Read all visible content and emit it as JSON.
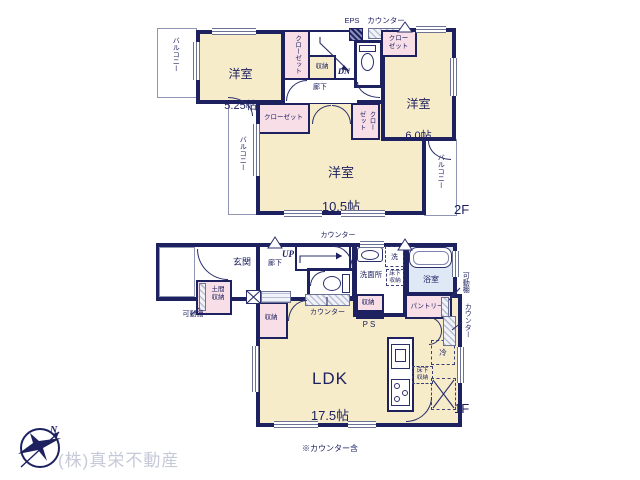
{
  "colors": {
    "wall_navy": "#1e2160",
    "room_cream": "#f7ecca",
    "closet_pink": "#f8dee6",
    "bath_blue": "#dfe9f5",
    "outline_gray": "#8f96b5",
    "logo_gray": "#c6c9d8"
  },
  "floor2": {
    "floor_label": "2F",
    "room525_name": "洋室",
    "room525_size": "5.25帖",
    "room60_name": "洋室",
    "room60_size": "6.0帖",
    "room105_name": "洋室",
    "room105_size": "10.5帖",
    "balcony_top": "バルコニー",
    "balcony_left": "バルコニー",
    "balcony_right": "バルコニー",
    "closet_525": "クローゼット",
    "closet_105h": "クローゼット",
    "closet_105v": "クローゼット",
    "closet_60": "クロー\nゼット",
    "storage": "収納",
    "hall": "廊下",
    "dn": "DN",
    "eps": "EPS",
    "counter_top": "カウンター"
  },
  "floor1": {
    "floor_label": "1F",
    "entrance": "玄関",
    "hall": "廊下",
    "up": "UP",
    "counter_top": "カウンター",
    "counter_mid": "カウンター",
    "counter_right": "カウンター",
    "doma": "土間\n収納",
    "shelf_left": "可動棚",
    "shelf_right": "可動棚",
    "washroom": "洗面所",
    "laundry": "洗",
    "underfloor_wash": "床下\n収納",
    "underfloor_kitchen": "床下\n収納",
    "bathroom": "浴室",
    "pantry": "パントリー",
    "storage_mid": "収納",
    "storage_ldk": "収納",
    "ps": "PS",
    "fridge": "冷",
    "ldk_name": "LDK",
    "ldk_size": "17.5帖",
    "ldk_note": "※カウンター含"
  },
  "footer": {
    "company": "(株)真栄不動産",
    "compass_n": "N"
  }
}
